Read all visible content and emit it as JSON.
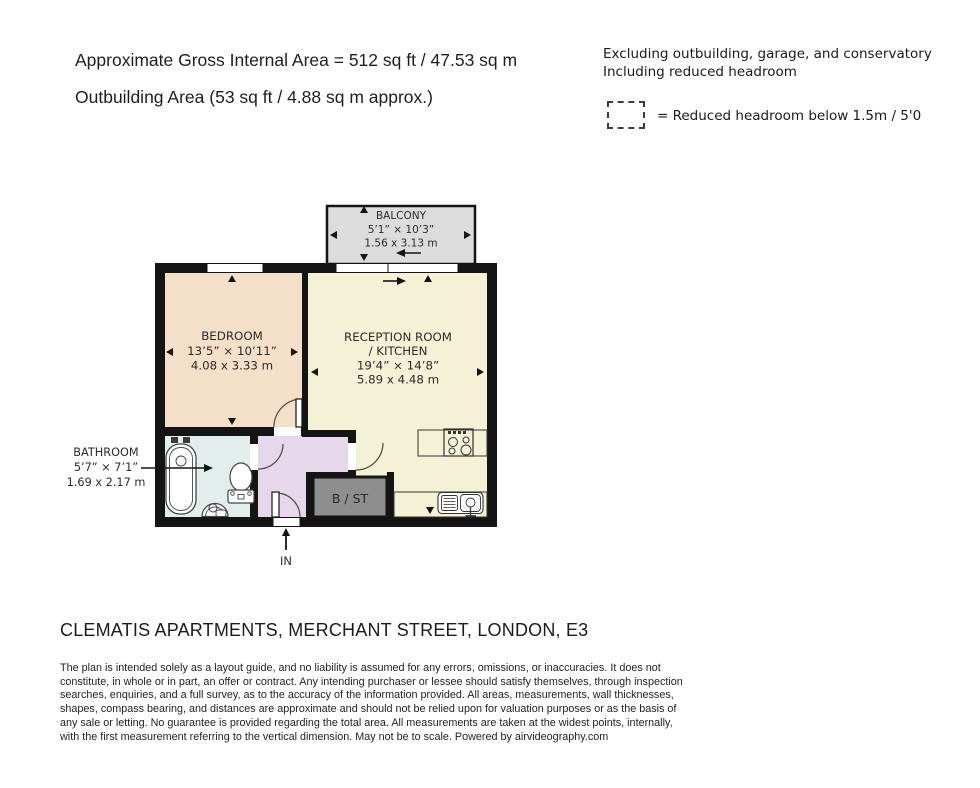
{
  "header": {
    "gross_area": "Approximate Gross Internal Area = 512 sq ft / 47.53 sq m",
    "outbuilding_area": "Outbuilding Area (53 sq ft / 4.88 sq m approx.)",
    "exclusions": "Excluding outbuilding, garage, and conservatory",
    "inclusions": "Including reduced headroom",
    "reduced_headroom_legend": "= Reduced headroom below 1.5m / 5'0"
  },
  "floorplan": {
    "balcony": {
      "name": "BALCONY",
      "dims_imperial": "5’1” × 10’3”",
      "dims_metric": "1.56 x 3.13 m"
    },
    "bedroom": {
      "name": "BEDROOM",
      "dims_imperial": "13’5” × 10’11”",
      "dims_metric": "4.08 x 3.33 m"
    },
    "reception": {
      "name_line1": "RECEPTION ROOM",
      "name_line2": "/ KITCHEN",
      "dims_imperial": "19’4” × 14’8”",
      "dims_metric": "5.89 x 4.48 m"
    },
    "bathroom": {
      "name": "BATHROOM",
      "dims_imperial": "5’7” × 7’1”",
      "dims_metric": "1.69 x 2.17 m"
    },
    "storage_label": "B / ST",
    "entrance_label": "IN"
  },
  "title": "CLEMATIS APARTMENTS, MERCHANT STREET, LONDON, E3",
  "disclaimer": {
    "lines": [
      "The plan is intended solely as a layout guide, and no liability is assumed for any errors, omissions, or inaccuracies. It does not",
      "constitute, in whole or in part, an offer or contract. Any intending purchaser or lessee should satisfy themselves, through inspection",
      "searches, enquiries, and a full survey, as to the accuracy of the information provided. All areas, measurements, wall thicknesses,",
      "shapes, compass bearing, and distances are approximate and should not be relied upon for valuation purposes or as the basis of",
      "any sale or letting. No guarantee is provided regarding the total area. All measurements are taken at the widest points, internally,",
      "with the first measurement referring to the vertical dimension. May not be to scale. Powered by airvideography.com"
    ]
  },
  "colors": {
    "wall": "#141414",
    "bedroom": "#f5dfc8",
    "reception": "#f4f1d6",
    "bathroom": "#e2eeec",
    "hallway": "#e7d7ea",
    "balcony": "#dcdcdc",
    "storage": "#8e8e8e"
  }
}
